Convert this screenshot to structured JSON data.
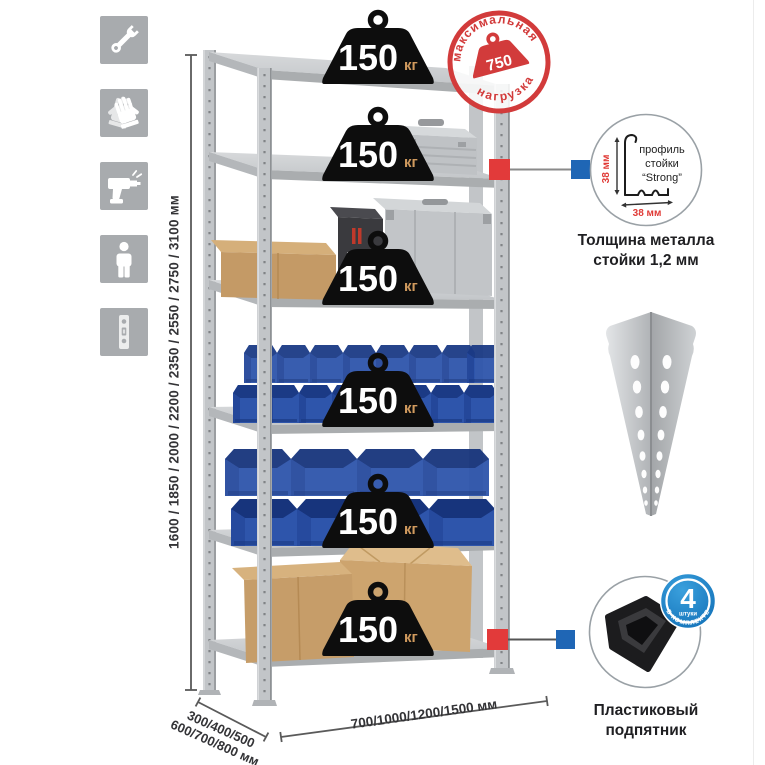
{
  "sidebar": {
    "background": "#a8abae",
    "icons": [
      {
        "name": "wrench-icon"
      },
      {
        "name": "gloves-icon"
      },
      {
        "name": "drill-icon"
      },
      {
        "name": "person-icon"
      },
      {
        "name": "rack-profile-icon"
      }
    ]
  },
  "rack": {
    "shelf_count": 6,
    "badge": {
      "value": "150",
      "unit": "кг"
    },
    "max_load_stamp": {
      "arc_top": "максимальная",
      "arc_bottom": "нагрузка",
      "value": "750",
      "unit": "кг",
      "color": "#d23b3b"
    }
  },
  "dimensions": {
    "height": "1600 / 1850 / 2000 / 2200 / 2350 / 2550 / 2750 / 3100 мм",
    "depth_line1": "300/400/500",
    "depth_line2": "600/700/800 мм",
    "width": "700/1000/1200/1500 мм"
  },
  "profile_detail": {
    "label_line1": "профиль",
    "label_line2": "стойки",
    "label_line3": "“Strong”",
    "dim_vertical": "38 мм",
    "dim_horizontal": "38 мм",
    "caption_line1": "Толщина металла",
    "caption_line2": "стойки 1,2 мм",
    "dim_color": "#e03a36"
  },
  "included_badge": {
    "count": "4",
    "unit_text": "штуки",
    "arc_text": "В КОМПЛЕКТЕ",
    "color": "#1581c6"
  },
  "foot_detail": {
    "caption_line1": "Пластиковый",
    "caption_line2": "подпятник"
  },
  "colors": {
    "metal": "#c2c5c8",
    "bin_blue": "#2e55ab",
    "stamp_red": "#d23b3b",
    "connector_red": "#e23a3a",
    "connector_blue": "#1f66b5",
    "cardboard": "#c49a66"
  }
}
